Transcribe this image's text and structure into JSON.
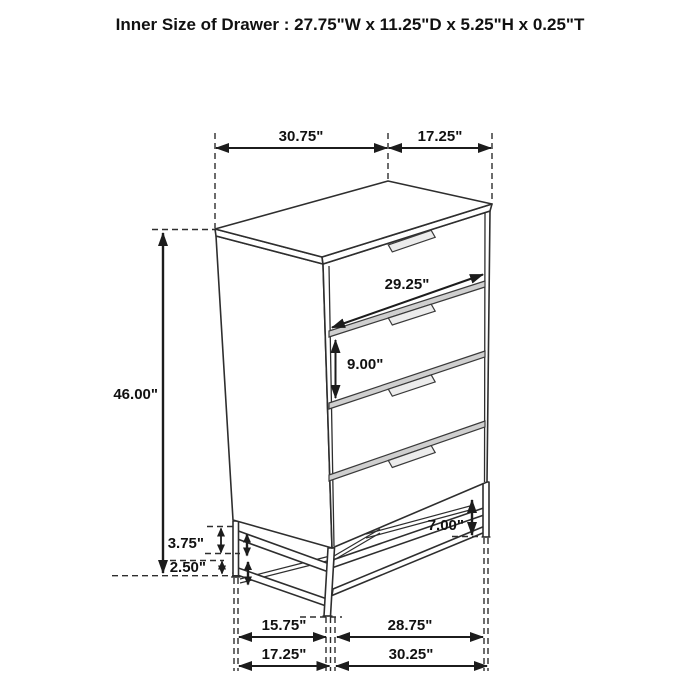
{
  "title": "Inner Size of Drawer : 27.75\"W x 11.25\"D x 5.25\"H x 0.25\"T",
  "dims": {
    "top_width": "30.75\"",
    "top_depth": "17.25\"",
    "drawer_width": "29.25\"",
    "drawer_front_height": "9.00\"",
    "overall_height": "46.00\"",
    "base_upper_gap": "3.75\"",
    "base_lower_gap": "2.50\"",
    "floor_clearance": "7.00\"",
    "base_inner_depth": "15.75\"",
    "base_inner_width": "28.75\"",
    "base_outer_depth": "17.25\"",
    "base_outer_width": "30.25\""
  },
  "colors": {
    "background": "#ffffff",
    "line": "#2e2e2e",
    "text": "#111111",
    "divider_fill": "#cfcfcf",
    "handle_fill": "#ececec"
  },
  "object": {
    "type": "4-drawer chest line drawing",
    "drawer_count": "4"
  }
}
